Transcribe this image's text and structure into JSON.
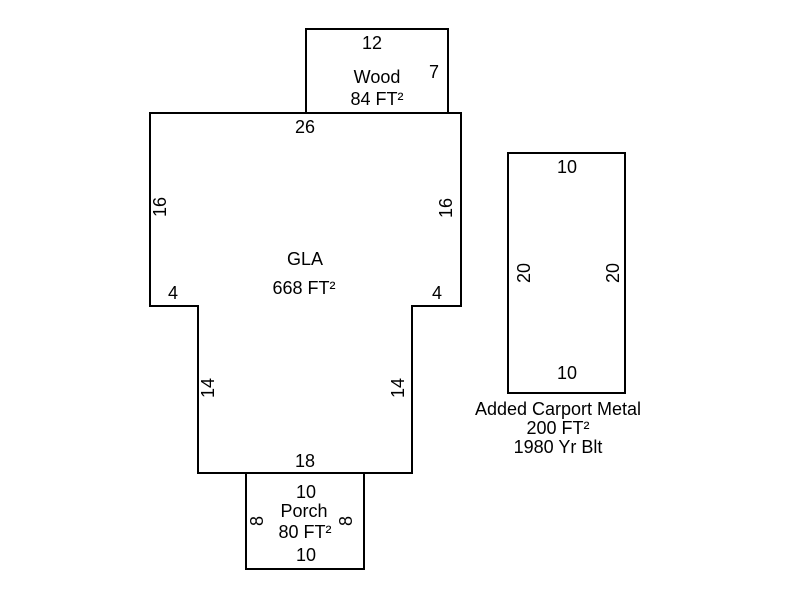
{
  "diagram": {
    "type": "floor-plan-sketch",
    "colors": {
      "background": "#ffffff",
      "line": "#000000",
      "text": "#000000"
    },
    "wood": {
      "label": "Wood",
      "area": "84 FT²",
      "dim_top": "12",
      "dim_right": "7"
    },
    "gla": {
      "label": "GLA",
      "area": "668 FT²",
      "dim_top": "26",
      "dim_left_upper": "16",
      "dim_right_upper": "16",
      "dim_left_notch": "4",
      "dim_right_notch": "4",
      "dim_left_lower": "14",
      "dim_right_lower": "14",
      "dim_bottom": "18"
    },
    "porch": {
      "label": "Porch",
      "area": "80 FT²",
      "dim_top": "10",
      "dim_left": "8",
      "dim_right": "8",
      "dim_bottom": "10"
    },
    "carport": {
      "dim_top": "10",
      "dim_left": "20",
      "dim_right": "20",
      "dim_bottom": "10",
      "caption": [
        "Added Carport Metal",
        "200 FT²",
        "1980 Yr Blt"
      ]
    }
  }
}
